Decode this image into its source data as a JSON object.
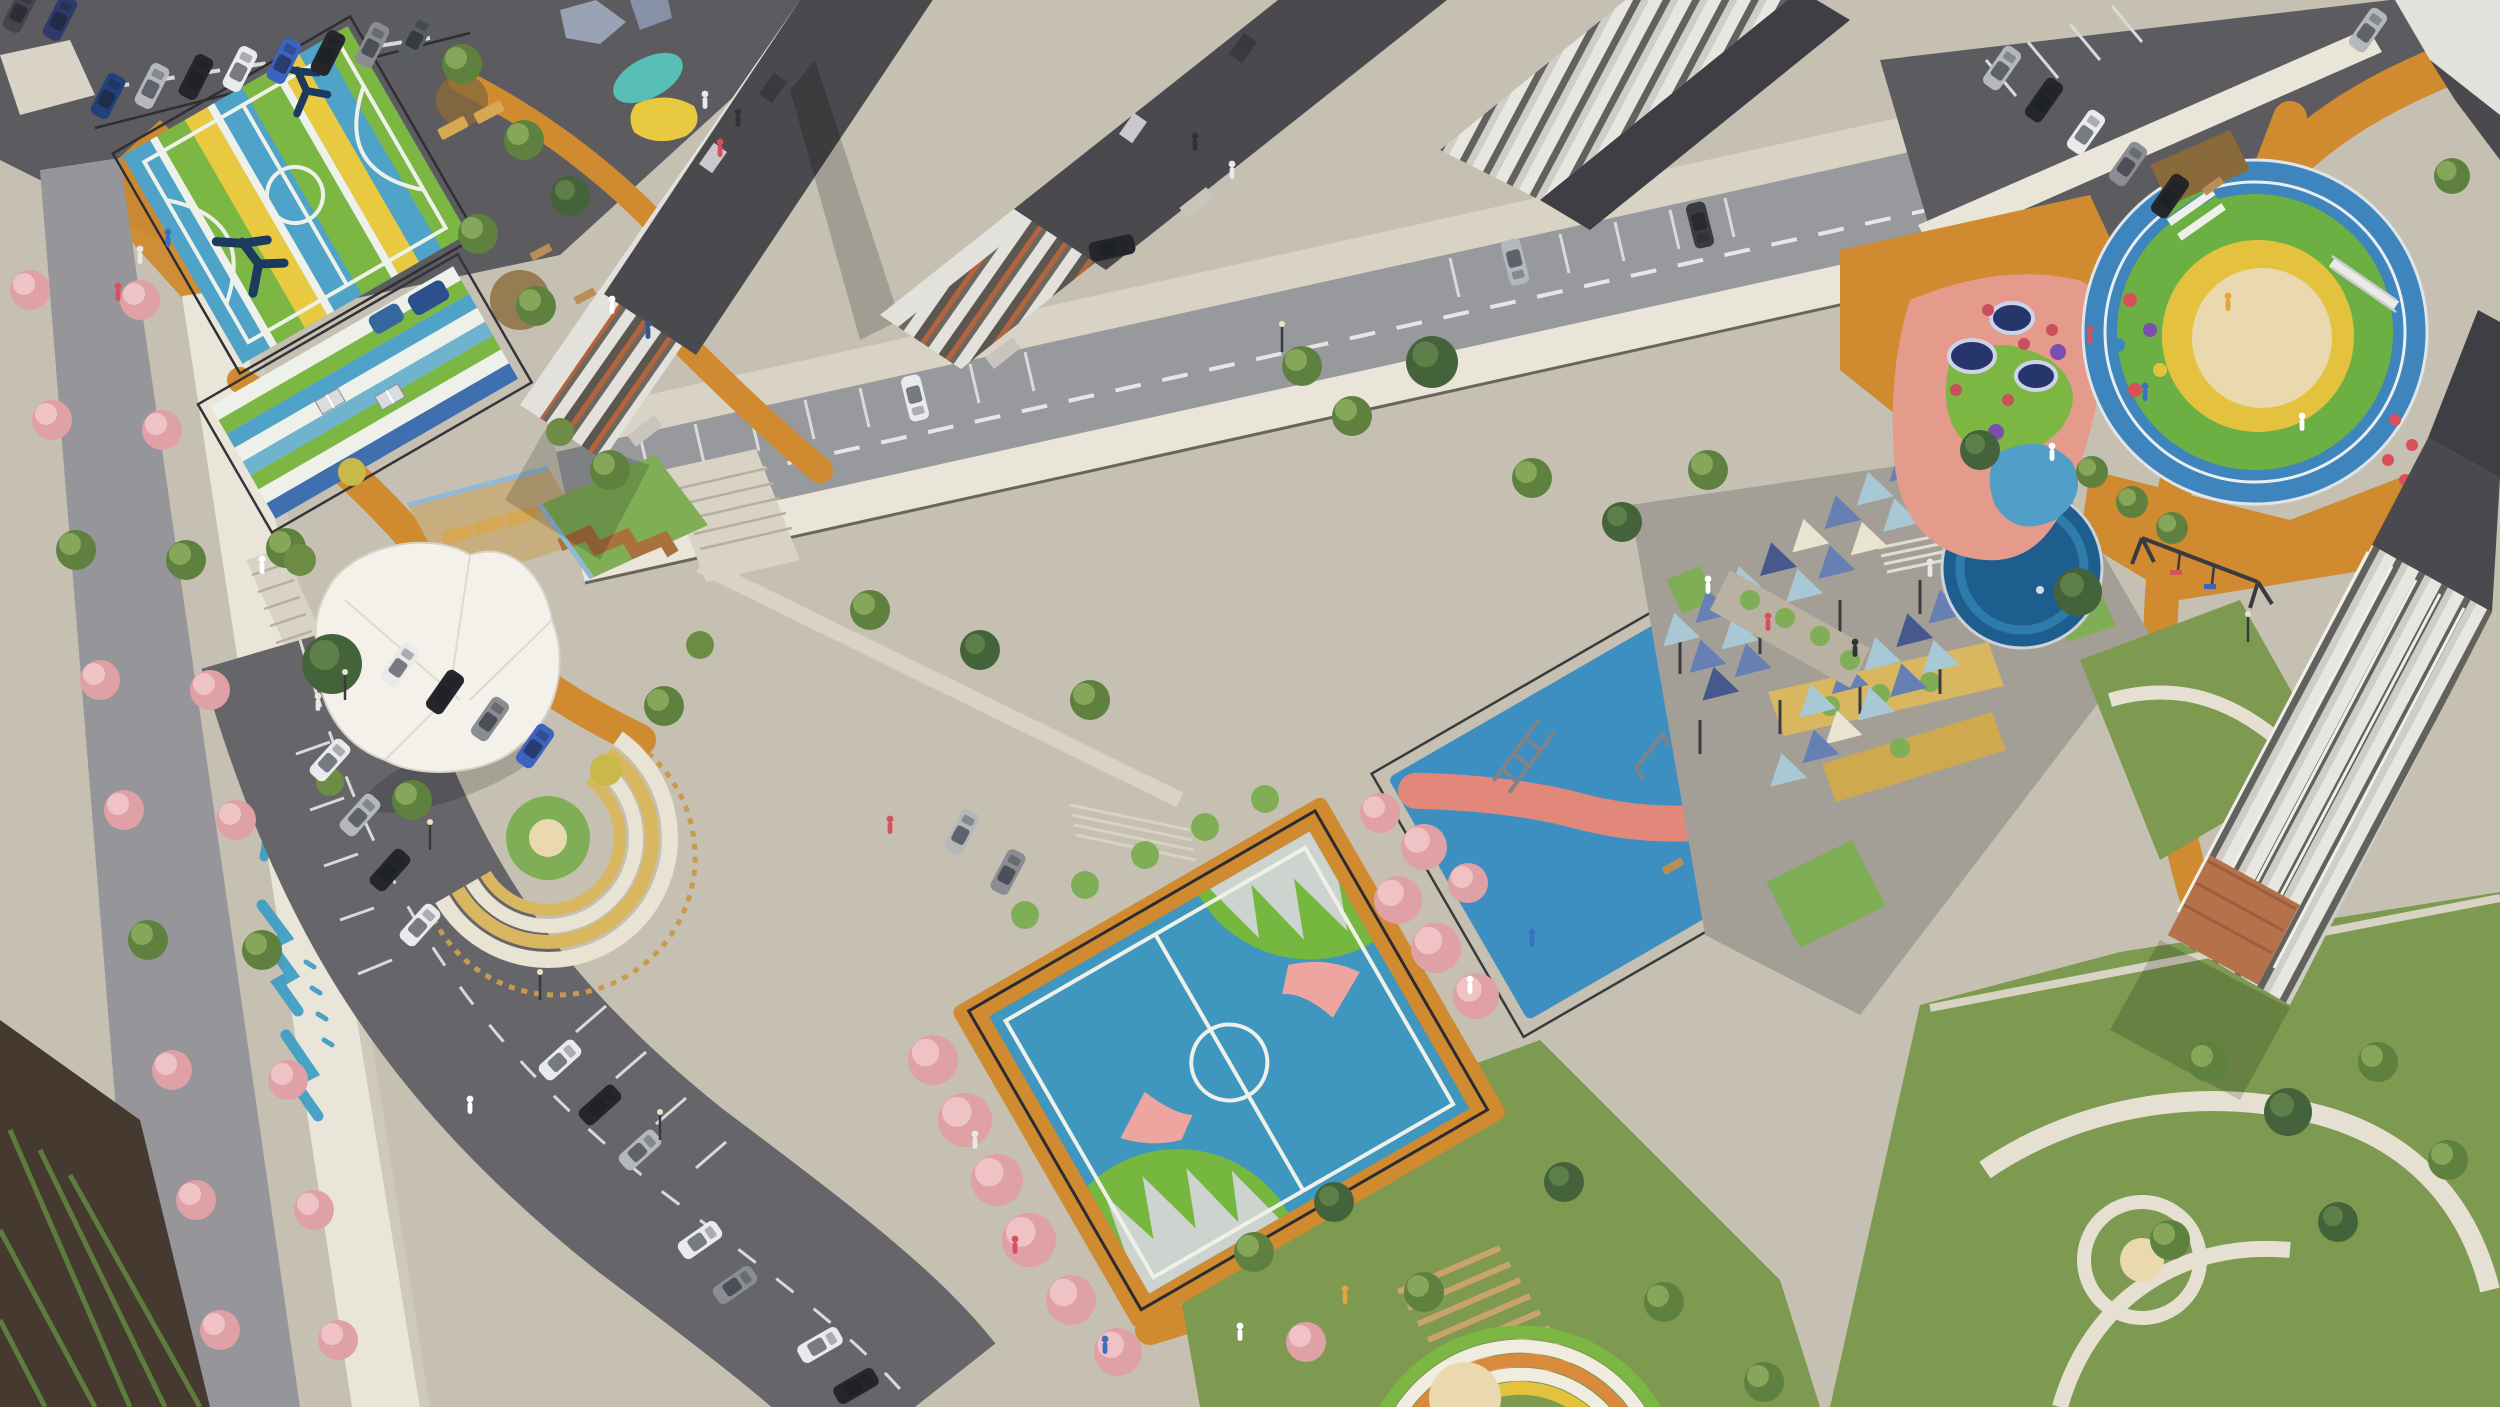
{
  "meta": {
    "type": "aerial-architectural-rendering",
    "subject": "bird's-eye render of a residential complex courtyard with sports courts, playgrounds, gardens, parking and towers",
    "canvas": {
      "width": 2500,
      "height": 1407
    },
    "camera": "high oblique aerial, scene rotated about -30 degrees"
  },
  "palette": {
    "asphalt_dark": "#5c5c60",
    "street": "#96959a",
    "road": "#98999c",
    "concrete": "#c6c0b2",
    "concrete_light": "#d9d3c5",
    "plaza": "#a49f96",
    "wall_light": "#eae5d9",
    "wall_shade": "#cfc9bb",
    "path_orange": "#d08a2f",
    "grass": "#7d9a50",
    "grass_bright": "#7fae57",
    "soil": "#463a30",
    "mulch": "#8a6a3a",
    "tree_green": "#5e813f",
    "tree_green_hl": "#86a75a",
    "tree_dark": "#45633a",
    "tree_pink": "#dfa0a6",
    "tree_pink_hl": "#efc3c6",
    "court_teal": "#4fa3c8",
    "court_green": "#7cb744",
    "court_yellow": "#e9c93f",
    "court_white": "#edf1e9",
    "court_navy": "#1c3a5e",
    "futsal_blue": "#3f96bf",
    "futsal_green": "#76b83f",
    "futsal_gray": "#cdd4cf",
    "futsal_pink": "#eda5a0",
    "workout_blue": "#3e8fc1",
    "workout_coral": "#e2887b",
    "sail_light": "#a9c8d6",
    "sail_blue": "#6680b4",
    "sail_navy": "#46588e",
    "sail_cream": "#e8e4cf",
    "ring_blue": "#3e84bd",
    "ring_green": "#6cb043",
    "ring_yellow": "#e4c23e",
    "sand": "#ead9ae",
    "salmon": "#e59b8b",
    "pond": "#1e5e8e",
    "pond_ring": "#2f7cab",
    "mural": "#3d9dc6",
    "roof_dark": "#4a4a4e",
    "roof_darker": "#3e3e44",
    "facade_light": "#e3e1dc",
    "facade_window": "#5b5650",
    "balcony_orange": "#b4643c",
    "terracotta": "#b5714a",
    "deck_wood": "#c8ad7f",
    "lounger": "#d7a853",
    "terrace_cream": "#e9e3d3",
    "terrace_yellow": "#d9b760",
    "tent": "#f4f1ea",
    "car_white": "#e9eaec",
    "car_black": "#26262a",
    "car_silver": "#b4b7bc",
    "car_blue": "#3c63c0",
    "car_gray": "#8a8d92",
    "line_white": "#dcdcdc"
  },
  "scene": {
    "areas": [
      {
        "name": "parking-lot-north",
        "desc": "angled parking row with cars along top-left road"
      },
      {
        "name": "basketball-court",
        "desc": "striped teal/green/yellow court with player silhouette murals"
      },
      {
        "name": "kids-striped-court",
        "desc": "striped green/blue play court with table-tennis tables"
      },
      {
        "name": "alley-street-west",
        "desc": "tree-lined street with pink blossoming trees"
      },
      {
        "name": "retaining-wall-mural",
        "desc": "white retaining wall with blue painted lettering mural"
      },
      {
        "name": "garden-event-tent",
        "desc": "white membrane canopy pavilion in landscaped garden"
      },
      {
        "name": "sun-deck",
        "desc": "wooden deck with sun loungers"
      },
      {
        "name": "amphitheater",
        "desc": "semicircular terraced seating"
      },
      {
        "name": "residential-towers",
        "desc": "two high-rise slabs with orange balcony bands"
      },
      {
        "name": "internal-road",
        "desc": "driveway with marked parking bays"
      },
      {
        "name": "futsal-court",
        "desc": "blue mini-football court with green mountain graphics"
      },
      {
        "name": "calisthenics-area",
        "desc": "blue workout pad with coral paths and steel equipment"
      },
      {
        "name": "shade-sail-plaza",
        "desc": "plaza covered by triangular shade sails"
      },
      {
        "name": "splash-pond",
        "desc": "dark blue round water feature"
      },
      {
        "name": "circular-kids-playground",
        "desc": "concentric blue/green/yellow rings around central sand pit"
      },
      {
        "name": "trampoline-zone",
        "desc": "salmon rubber area with in-ground trampolines and play domes"
      },
      {
        "name": "parking-lot-east",
        "desc": "parking row behind playground wall"
      },
      {
        "name": "residential-building-east",
        "desc": "slab building with terracotta accents"
      },
      {
        "name": "lawn-paths-southeast",
        "desc": "lawns with curving light paths"
      },
      {
        "name": "terraced-garden-south",
        "desc": "pergola slats and rainbow-striped walkway"
      },
      {
        "name": "curved-parking-road",
        "desc": "curved road with parallel parking bays"
      },
      {
        "name": "community-garden-plots",
        "desc": "dark soil beds with green crop rows"
      }
    ],
    "approx_counts": {
      "cars": 34,
      "people": 26,
      "shade_sails": 28,
      "trampolines": 3,
      "sun_loungers": 6
    }
  }
}
